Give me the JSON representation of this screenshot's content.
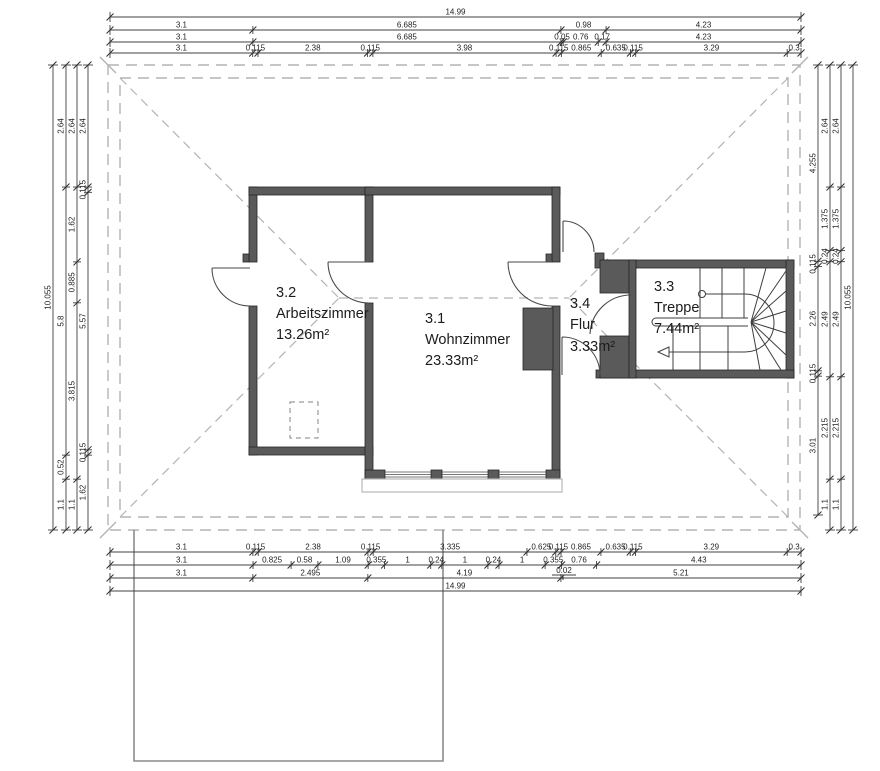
{
  "drawing": {
    "rooms": [
      {
        "number": "3.2",
        "name": "Arbeitszimmer",
        "area": "13.26m²"
      },
      {
        "number": "3.1",
        "name": "Wohnzimmer",
        "area": "23.33m²"
      },
      {
        "number": "3.4",
        "name": "Flur",
        "area": "3.33m²"
      },
      {
        "number": "3.3",
        "name": "Treppe",
        "area": "7.44m²"
      }
    ]
  },
  "dimensions": {
    "top": [
      {
        "values": [
          "14.99"
        ]
      },
      {
        "values": [
          "3.1",
          "6.685",
          "0.98",
          "4.23"
        ]
      },
      {
        "values": [
          "3.1",
          "6.685",
          "0.05",
          "0.76",
          "0.17",
          "4.23"
        ]
      },
      {
        "values": [
          "3.1",
          "0.115",
          "2.38",
          "0.115",
          "3.98",
          "0.115",
          "0.865",
          "0.635",
          "0.115",
          "3.29",
          "0.3"
        ]
      }
    ],
    "bottom": [
      {
        "values": [
          "3.1",
          "0.115",
          "2.38",
          "0.115",
          "3.335",
          "0.625",
          "0.115",
          "0.865",
          "0.635",
          "0.115",
          "3.29",
          "0.3"
        ]
      },
      {
        "values": [
          "3.1",
          "0.825",
          "0.58",
          "1.09",
          "0.355",
          "1",
          "0.24",
          "1",
          "0.24",
          "1",
          "0.355",
          "0.76",
          "4.43"
        ]
      },
      {
        "values": [
          "3.1",
          "2.495",
          "4.19",
          "5.21"
        ]
      },
      {
        "values": [
          "14.99"
        ]
      }
    ],
    "left": [
      {
        "values": [
          "10.055"
        ]
      },
      {
        "values": [
          "2.64",
          "5.8",
          "0.52",
          "1.1"
        ]
      },
      {
        "values": [
          "2.64",
          "1.62",
          "0.885",
          "3.815",
          "1.1"
        ]
      },
      {
        "values": [
          "2.64",
          "0.115",
          "5.57",
          "0.115",
          "1.62"
        ]
      }
    ],
    "right": [
      {
        "values": [
          "4.255",
          "0.115",
          "2.26",
          "0.115",
          "3.01"
        ]
      },
      {
        "values": [
          "2.64",
          "1.375",
          "0.24",
          "2.49",
          "2.215",
          "1.1"
        ]
      },
      {
        "values": [
          "2.64",
          "1.375",
          "0.24",
          "2.49",
          "2.215",
          "1.1"
        ]
      },
      {
        "values": [
          "10.055"
        ]
      }
    ]
  },
  "annotations": {
    "offset_label": "0.02"
  },
  "colors": {
    "wall": "#5a5a5a",
    "dashed": "#b3b3b3",
    "dim_line": "#404040",
    "text": "#1c1c1c"
  }
}
